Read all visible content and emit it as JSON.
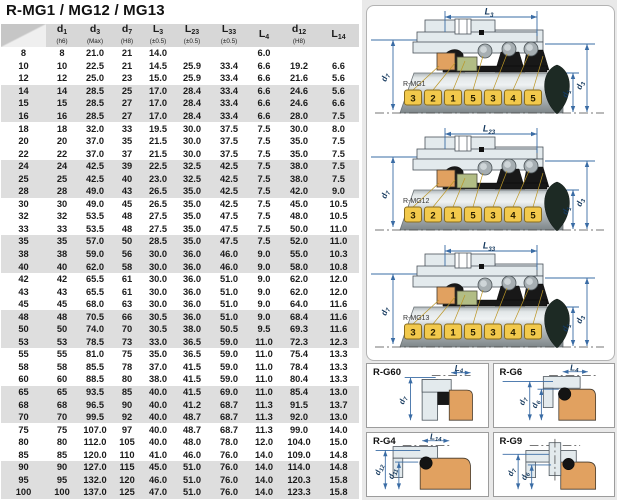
{
  "title": "R-MG1 / MG12 / MG13",
  "colors": {
    "dimension_blue": "#3A6CA5",
    "seat_orange": "#E1A160",
    "tag_yellow": "#F2C94C",
    "row_stripe_gray": "#DEDEDE",
    "header_gray": "#D7D7D7",
    "elastomer_green": "#B2BD85"
  },
  "table": {
    "columns": [
      {
        "base": "d",
        "sub": "1",
        "note": "(h6)"
      },
      {
        "base": "d",
        "sub": "3",
        "note": "(Max)"
      },
      {
        "base": "d",
        "sub": "7",
        "note": "(H8)"
      },
      {
        "base": "L",
        "sub": "3",
        "note": "(±0.5)"
      },
      {
        "base": "L",
        "sub": "23",
        "note": "(±0.5)"
      },
      {
        "base": "L",
        "sub": "33",
        "note": "(±0.5)"
      },
      {
        "base": "L",
        "sub": "4",
        "note": ""
      },
      {
        "base": "d",
        "sub": "12",
        "note": "(H8)"
      },
      {
        "base": "L",
        "sub": "14",
        "note": ""
      }
    ],
    "rows": [
      {
        "id": "8",
        "values": [
          "8",
          "21.0",
          "21",
          "14.0",
          "",
          "",
          "6.0",
          "",
          ""
        ]
      },
      {
        "id": "10",
        "values": [
          "10",
          "22.5",
          "21",
          "14.5",
          "25.9",
          "33.4",
          "6.6",
          "19.2",
          "6.6"
        ]
      },
      {
        "id": "12",
        "values": [
          "12",
          "25.0",
          "23",
          "15.0",
          "25.9",
          "33.4",
          "6.6",
          "21.6",
          "5.6"
        ]
      },
      {
        "id": "14",
        "values": [
          "14",
          "28.5",
          "25",
          "17.0",
          "28.4",
          "33.4",
          "6.6",
          "24.6",
          "5.6"
        ]
      },
      {
        "id": "15",
        "values": [
          "15",
          "28.5",
          "27",
          "17.0",
          "28.4",
          "33.4",
          "6.6",
          "24.6",
          "6.6"
        ]
      },
      {
        "id": "16",
        "values": [
          "16",
          "28.5",
          "27",
          "17.0",
          "28.4",
          "33.4",
          "6.6",
          "28.0",
          "7.5"
        ]
      },
      {
        "id": "18",
        "values": [
          "18",
          "32.0",
          "33",
          "19.5",
          "30.0",
          "37.5",
          "7.5",
          "30.0",
          "8.0"
        ]
      },
      {
        "id": "20",
        "values": [
          "20",
          "37.0",
          "35",
          "21.5",
          "30.0",
          "37.5",
          "7.5",
          "35.0",
          "7.5"
        ]
      },
      {
        "id": "22",
        "values": [
          "22",
          "37.0",
          "37",
          "21.5",
          "30.0",
          "37.5",
          "7.5",
          "35.0",
          "7.5"
        ]
      },
      {
        "id": "24",
        "values": [
          "24",
          "42.5",
          "39",
          "22.5",
          "32.5",
          "42.5",
          "7.5",
          "38.0",
          "7.5"
        ]
      },
      {
        "id": "25",
        "values": [
          "25",
          "42.5",
          "40",
          "23.0",
          "32.5",
          "42.5",
          "7.5",
          "38.0",
          "7.5"
        ]
      },
      {
        "id": "28",
        "values": [
          "28",
          "49.0",
          "43",
          "26.5",
          "35.0",
          "42.5",
          "7.5",
          "42.0",
          "9.0"
        ]
      },
      {
        "id": "30",
        "values": [
          "30",
          "49.0",
          "45",
          "26.5",
          "35.0",
          "42.5",
          "7.5",
          "45.0",
          "10.5"
        ]
      },
      {
        "id": "32",
        "values": [
          "32",
          "53.5",
          "48",
          "27.5",
          "35.0",
          "47.5",
          "7.5",
          "48.0",
          "10.5"
        ]
      },
      {
        "id": "33",
        "values": [
          "33",
          "53.5",
          "48",
          "27.5",
          "35.0",
          "47.5",
          "7.5",
          "50.0",
          "11.0"
        ]
      },
      {
        "id": "35",
        "values": [
          "35",
          "57.0",
          "50",
          "28.5",
          "35.0",
          "47.5",
          "7.5",
          "52.0",
          "11.0"
        ]
      },
      {
        "id": "38",
        "values": [
          "38",
          "59.0",
          "56",
          "30.0",
          "36.0",
          "46.0",
          "9.0",
          "55.0",
          "10.3"
        ]
      },
      {
        "id": "40",
        "values": [
          "40",
          "62.0",
          "58",
          "30.0",
          "36.0",
          "46.0",
          "9.0",
          "58.0",
          "10.8"
        ]
      },
      {
        "id": "42",
        "values": [
          "42",
          "65.5",
          "61",
          "30.0",
          "36.0",
          "51.0",
          "9.0",
          "62.0",
          "12.0"
        ]
      },
      {
        "id": "43",
        "values": [
          "43",
          "65.5",
          "61",
          "30.0",
          "36.0",
          "51.0",
          "9.0",
          "62.0",
          "12.0"
        ]
      },
      {
        "id": "45",
        "values": [
          "45",
          "68.0",
          "63",
          "30.0",
          "36.0",
          "51.0",
          "9.0",
          "64.0",
          "11.6"
        ]
      },
      {
        "id": "48",
        "values": [
          "48",
          "70.5",
          "66",
          "30.5",
          "36.0",
          "51.0",
          "9.0",
          "68.4",
          "11.6"
        ]
      },
      {
        "id": "50",
        "values": [
          "50",
          "74.0",
          "70",
          "30.5",
          "38.0",
          "50.5",
          "9.5",
          "69.3",
          "11.6"
        ]
      },
      {
        "id": "53",
        "values": [
          "53",
          "78.5",
          "73",
          "33.0",
          "36.5",
          "59.0",
          "11.0",
          "72.3",
          "12.3"
        ]
      },
      {
        "id": "55",
        "values": [
          "55",
          "81.0",
          "75",
          "35.0",
          "36.5",
          "59.0",
          "11.0",
          "75.4",
          "13.3"
        ]
      },
      {
        "id": "58",
        "values": [
          "58",
          "85.5",
          "78",
          "37.0",
          "41.5",
          "59.0",
          "11.0",
          "78.4",
          "13.3"
        ]
      },
      {
        "id": "60",
        "values": [
          "60",
          "88.5",
          "80",
          "38.0",
          "41.5",
          "59.0",
          "11.0",
          "80.4",
          "13.3"
        ]
      },
      {
        "id": "65",
        "values": [
          "65",
          "93.5",
          "85",
          "40.0",
          "41.5",
          "69.0",
          "11.0",
          "85.4",
          "13.0"
        ]
      },
      {
        "id": "68",
        "values": [
          "68",
          "96.5",
          "90",
          "40.0",
          "41.2",
          "68.7",
          "11.3",
          "91.5",
          "13.7"
        ]
      },
      {
        "id": "70",
        "values": [
          "70",
          "99.5",
          "92",
          "40.0",
          "48.7",
          "68.7",
          "11.3",
          "92.0",
          "13.0"
        ]
      },
      {
        "id": "75",
        "values": [
          "75",
          "107.0",
          "97",
          "40.0",
          "48.7",
          "68.7",
          "11.3",
          "99.0",
          "14.0"
        ]
      },
      {
        "id": "80",
        "values": [
          "80",
          "112.0",
          "105",
          "40.0",
          "48.0",
          "78.0",
          "12.0",
          "104.0",
          "15.0"
        ]
      },
      {
        "id": "85",
        "values": [
          "85",
          "120.0",
          "110",
          "41.0",
          "46.0",
          "76.0",
          "14.0",
          "109.0",
          "14.8"
        ]
      },
      {
        "id": "90",
        "values": [
          "90",
          "127.0",
          "115",
          "45.0",
          "51.0",
          "76.0",
          "14.0",
          "114.0",
          "14.8"
        ]
      },
      {
        "id": "95",
        "values": [
          "95",
          "132.0",
          "120",
          "46.0",
          "51.0",
          "76.0",
          "14.0",
          "120.3",
          "15.8"
        ]
      },
      {
        "id": "100",
        "values": [
          "100",
          "137.0",
          "125",
          "47.0",
          "51.0",
          "76.0",
          "14.0",
          "123.3",
          "15.8"
        ]
      }
    ]
  },
  "diagrams": {
    "tags": [
      "3",
      "2",
      "1",
      "5",
      "3",
      "4",
      "5"
    ],
    "axis": {
      "left": {
        "base": "d",
        "sub": "7"
      },
      "right_inner": {
        "base": "d",
        "sub": "1"
      },
      "right_outer": {
        "base": "d",
        "sub": "3"
      }
    },
    "items": [
      {
        "name": "R-MG1",
        "dim": {
          "base": "L",
          "sub": "3"
        }
      },
      {
        "name": "R-MG12",
        "dim": {
          "base": "L",
          "sub": "23"
        }
      },
      {
        "name": "R-MG13",
        "dim": {
          "base": "L",
          "sub": "33"
        }
      }
    ]
  },
  "seats": [
    {
      "name": "R-G60",
      "top_dim": {
        "base": "L",
        "sub": "4"
      },
      "left_dims": [
        {
          "base": "d",
          "sub": "7"
        }
      ]
    },
    {
      "name": "R-G6",
      "top_dim": {
        "base": "L",
        "sub": "4"
      },
      "left_dims": [
        {
          "base": "d",
          "sub": "7"
        },
        {
          "base": "d",
          "sub": "6"
        }
      ]
    },
    {
      "name": "R-G4",
      "top_dim": {
        "base": "L",
        "sub": "14"
      },
      "left_dims": [
        {
          "base": "d",
          "sub": "12"
        },
        {
          "base": "d",
          "sub": "11"
        }
      ]
    },
    {
      "name": "R-G9",
      "top_dim": null,
      "left_dims": [
        {
          "base": "d",
          "sub": "7"
        },
        {
          "base": "d",
          "sub": "6"
        }
      ]
    }
  ]
}
